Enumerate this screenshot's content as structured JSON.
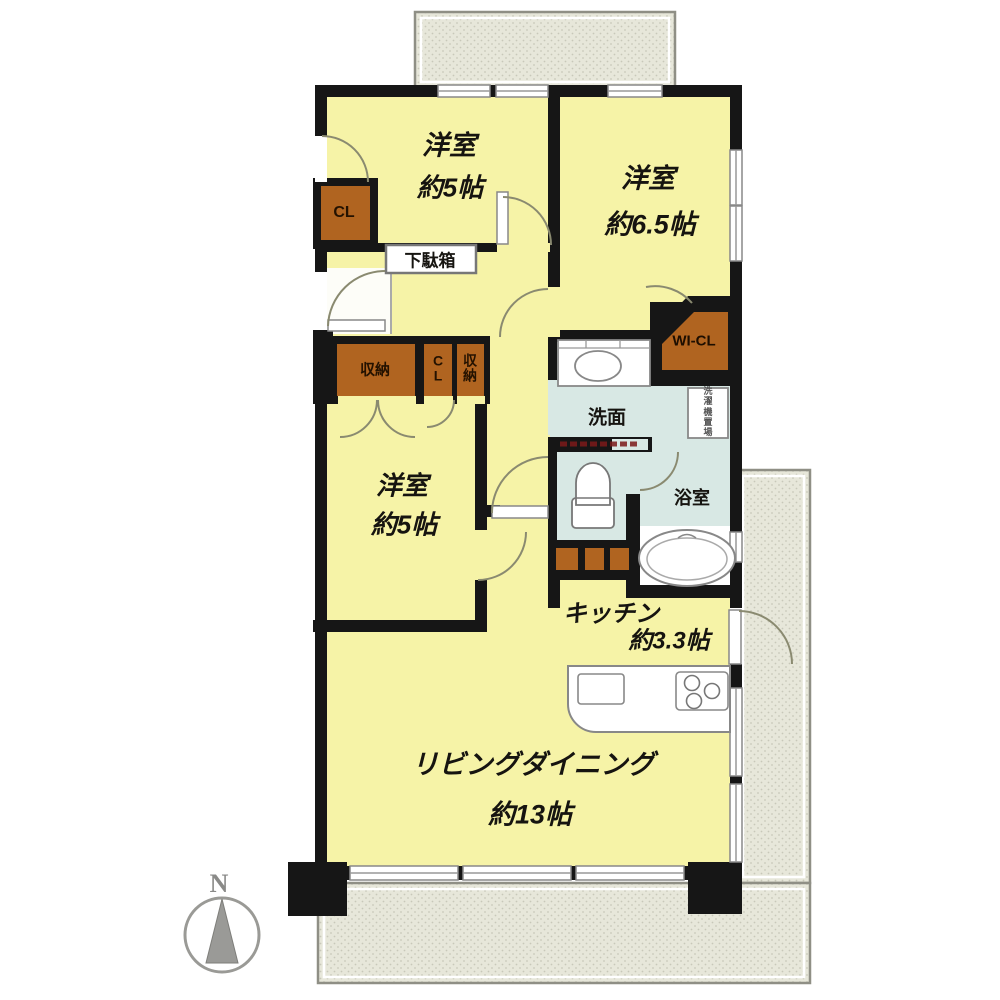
{
  "compass": {
    "north_label": "N"
  },
  "rooms": {
    "bedroom_top_left": {
      "name": "洋室",
      "size": "約5帖"
    },
    "bedroom_top_right": {
      "name": "洋室",
      "size": "約6.5帖"
    },
    "bedroom_middle": {
      "name": "洋室",
      "size": "約5帖"
    },
    "living_dining": {
      "name": "リビングダイニング",
      "size": "約13帖"
    },
    "kitchen": {
      "name": "キッチン",
      "size": "約3.3帖"
    },
    "washroom": {
      "name": "洗面"
    },
    "bathroom": {
      "name": "浴室"
    }
  },
  "storage": {
    "closet_top_left": "CL",
    "shoe_cabinet": "下駄箱",
    "storage_wide": "収納",
    "closet_middle": "CL",
    "storage_narrow": "収納",
    "walk_in_closet": "WI-CL",
    "laundry_space": "洗濯機置場"
  },
  "colors": {
    "room_fill": "#f6f3a7",
    "wet_area_fill": "#d8e8e4",
    "storage_fill": "#b06420",
    "balcony_fill": "#e7e7da",
    "wall": "#161616"
  }
}
